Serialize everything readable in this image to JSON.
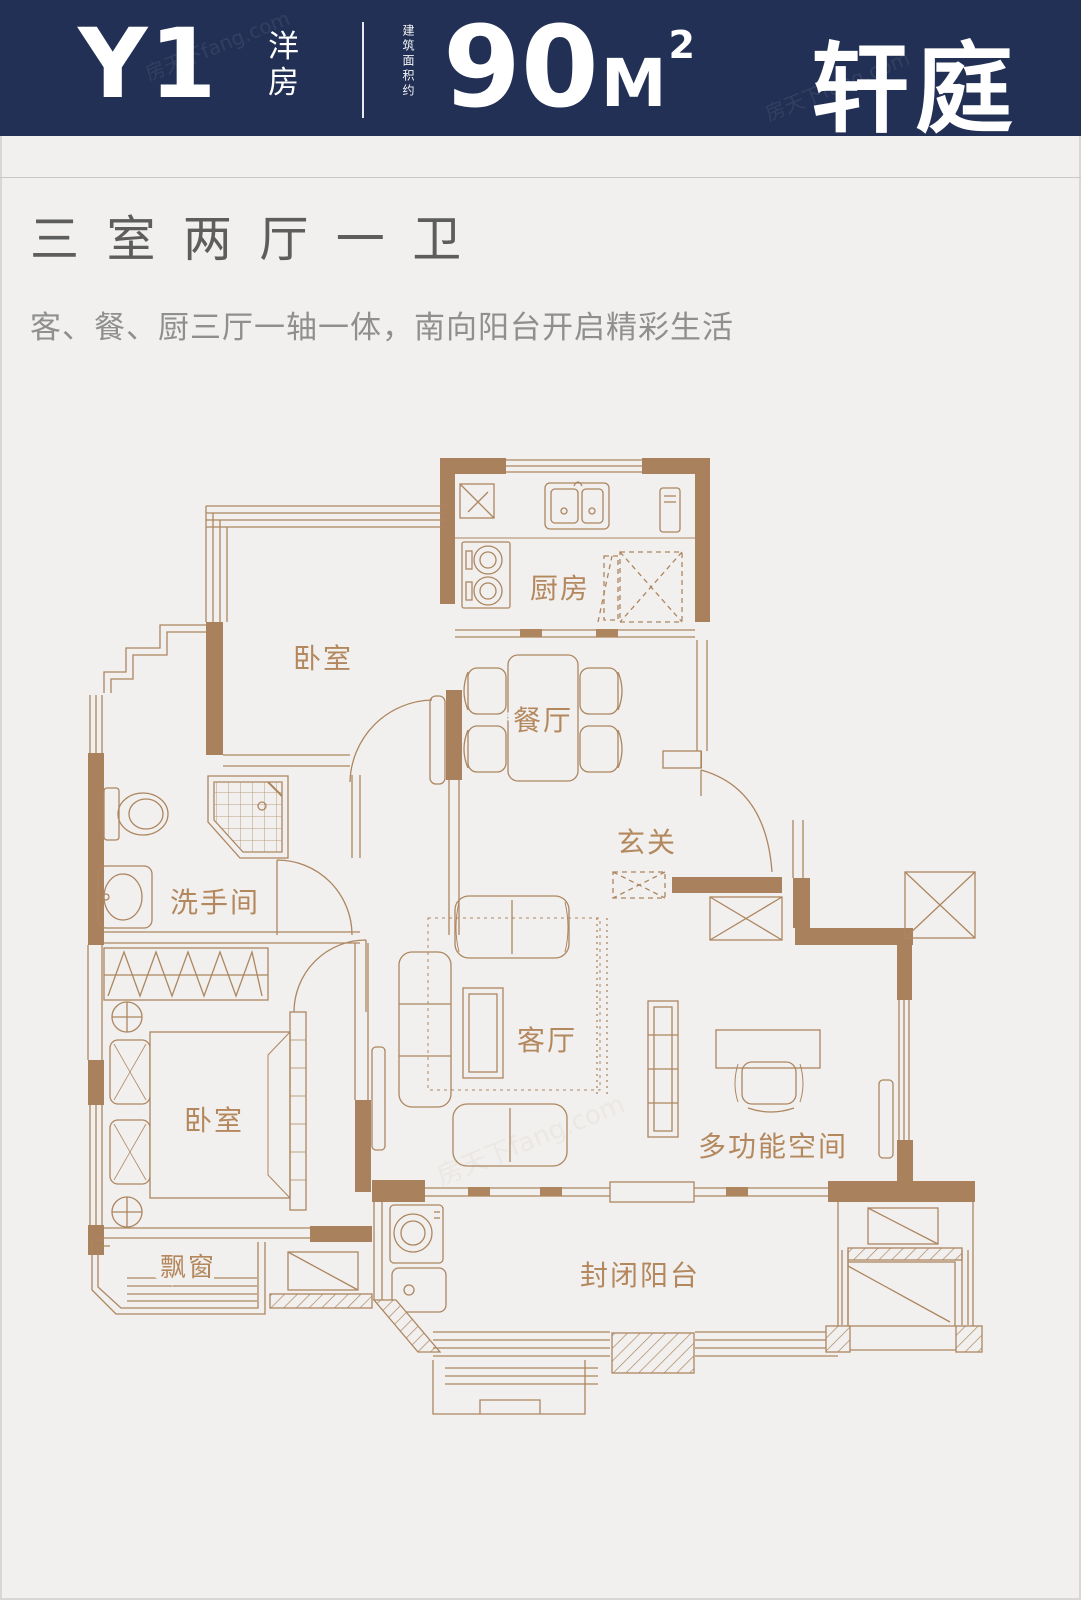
{
  "header": {
    "unit_code": "Y1",
    "unit_type": "洋\n房",
    "area_prefix": "建筑面积约",
    "area_value": "90",
    "area_unit": "M",
    "area_sup": "2",
    "unit_name": "轩庭",
    "bg_color": "#223055",
    "text_color": "#ffffff"
  },
  "summary": {
    "title": "三室两厅一卫",
    "subtitle": "客、餐、厨三厅一轴一体，南向阳台开启精彩生活"
  },
  "floorplan": {
    "wall_color": "#a9825d",
    "line_color": "#ad8660",
    "label_color": "#b4885e",
    "rooms": {
      "kitchen": "厨房",
      "bedroom_top": "卧室",
      "dining": "餐厅",
      "foyer": "玄关",
      "bathroom": "洗手间",
      "living": "客厅",
      "bedroom_bottom": "卧室",
      "multi": "多功能空间",
      "bay_window": "飘窗",
      "balcony": "封闭阳台"
    }
  },
  "watermark": "房天下fang.com"
}
